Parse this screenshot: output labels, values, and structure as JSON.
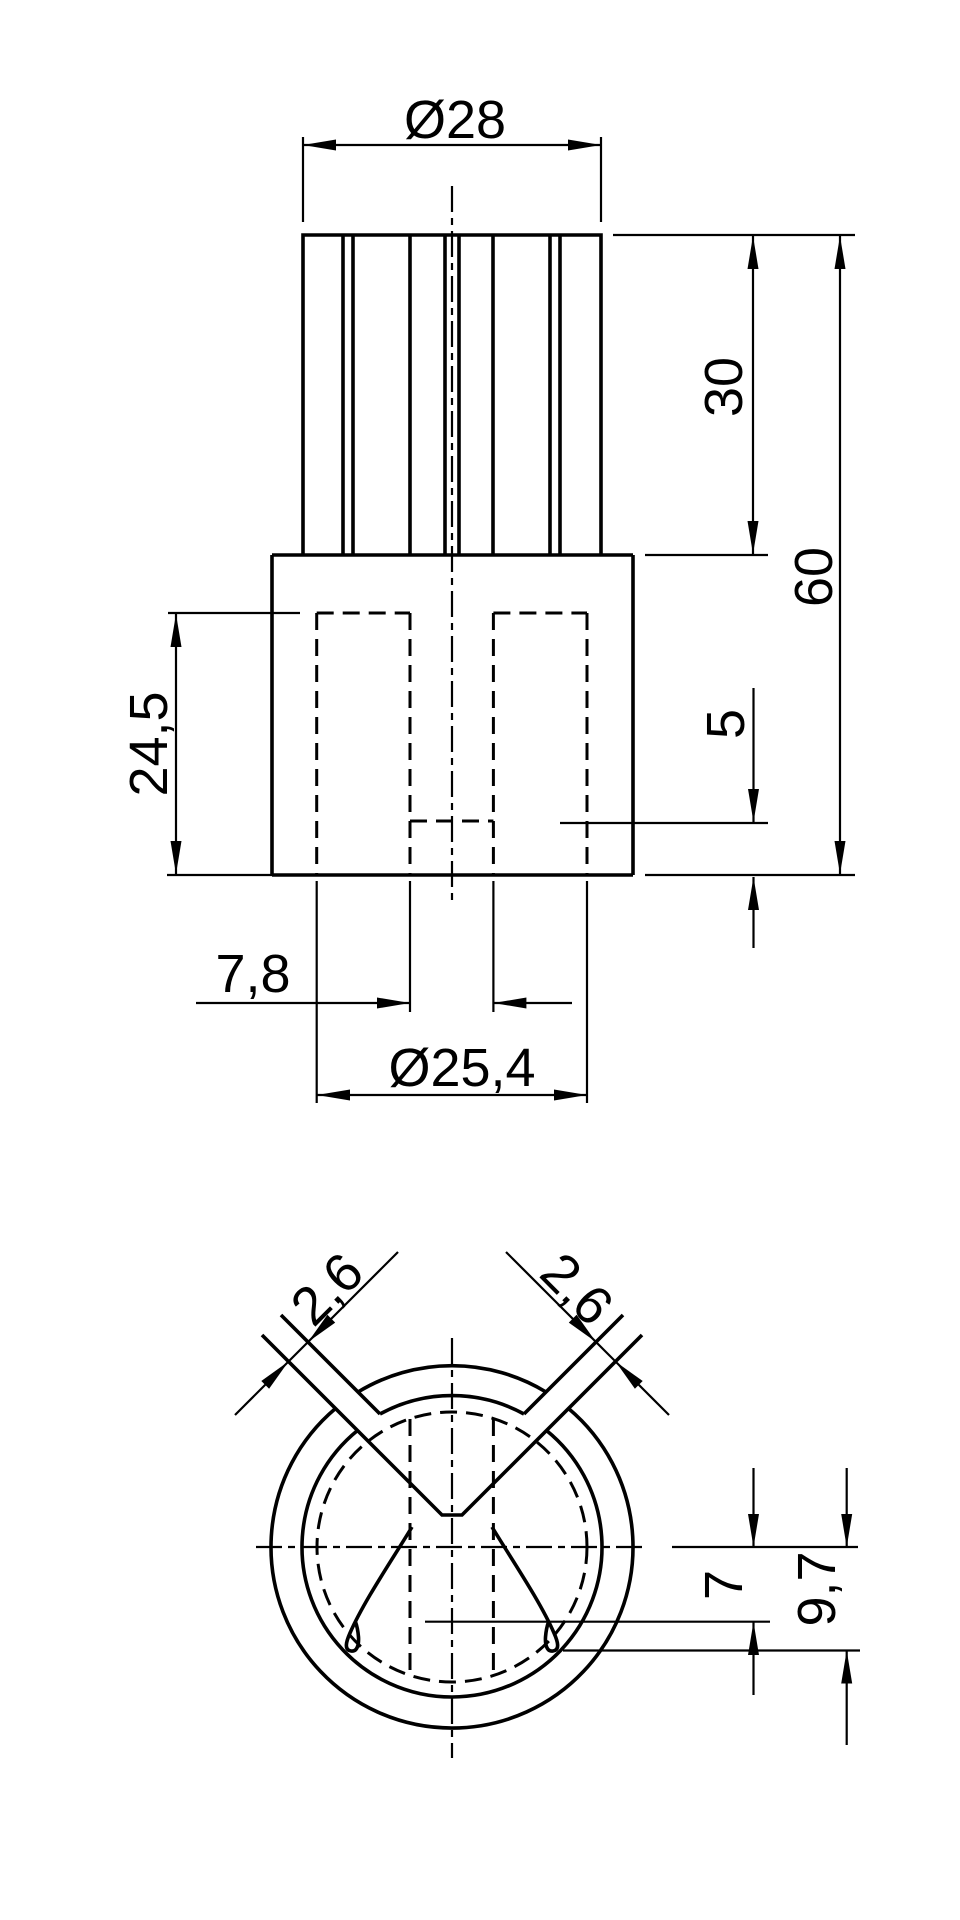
{
  "colors": {
    "line": "#000000",
    "background": "#ffffff"
  },
  "views": {
    "front": {
      "title": "front-view",
      "dims": {
        "dia_top": "Ø28",
        "rib_height": "30",
        "total_height": "60",
        "slot_depth": "24,5",
        "web_thickness": "5",
        "channel_width": "7,8",
        "dia_bore": "Ø25,4"
      }
    },
    "bottom": {
      "title": "bottom-section-view",
      "dims": {
        "slot_left": "2,6",
        "slot_right": "2,6",
        "hook_inner": "7",
        "hook_outer": "9,7"
      }
    }
  }
}
